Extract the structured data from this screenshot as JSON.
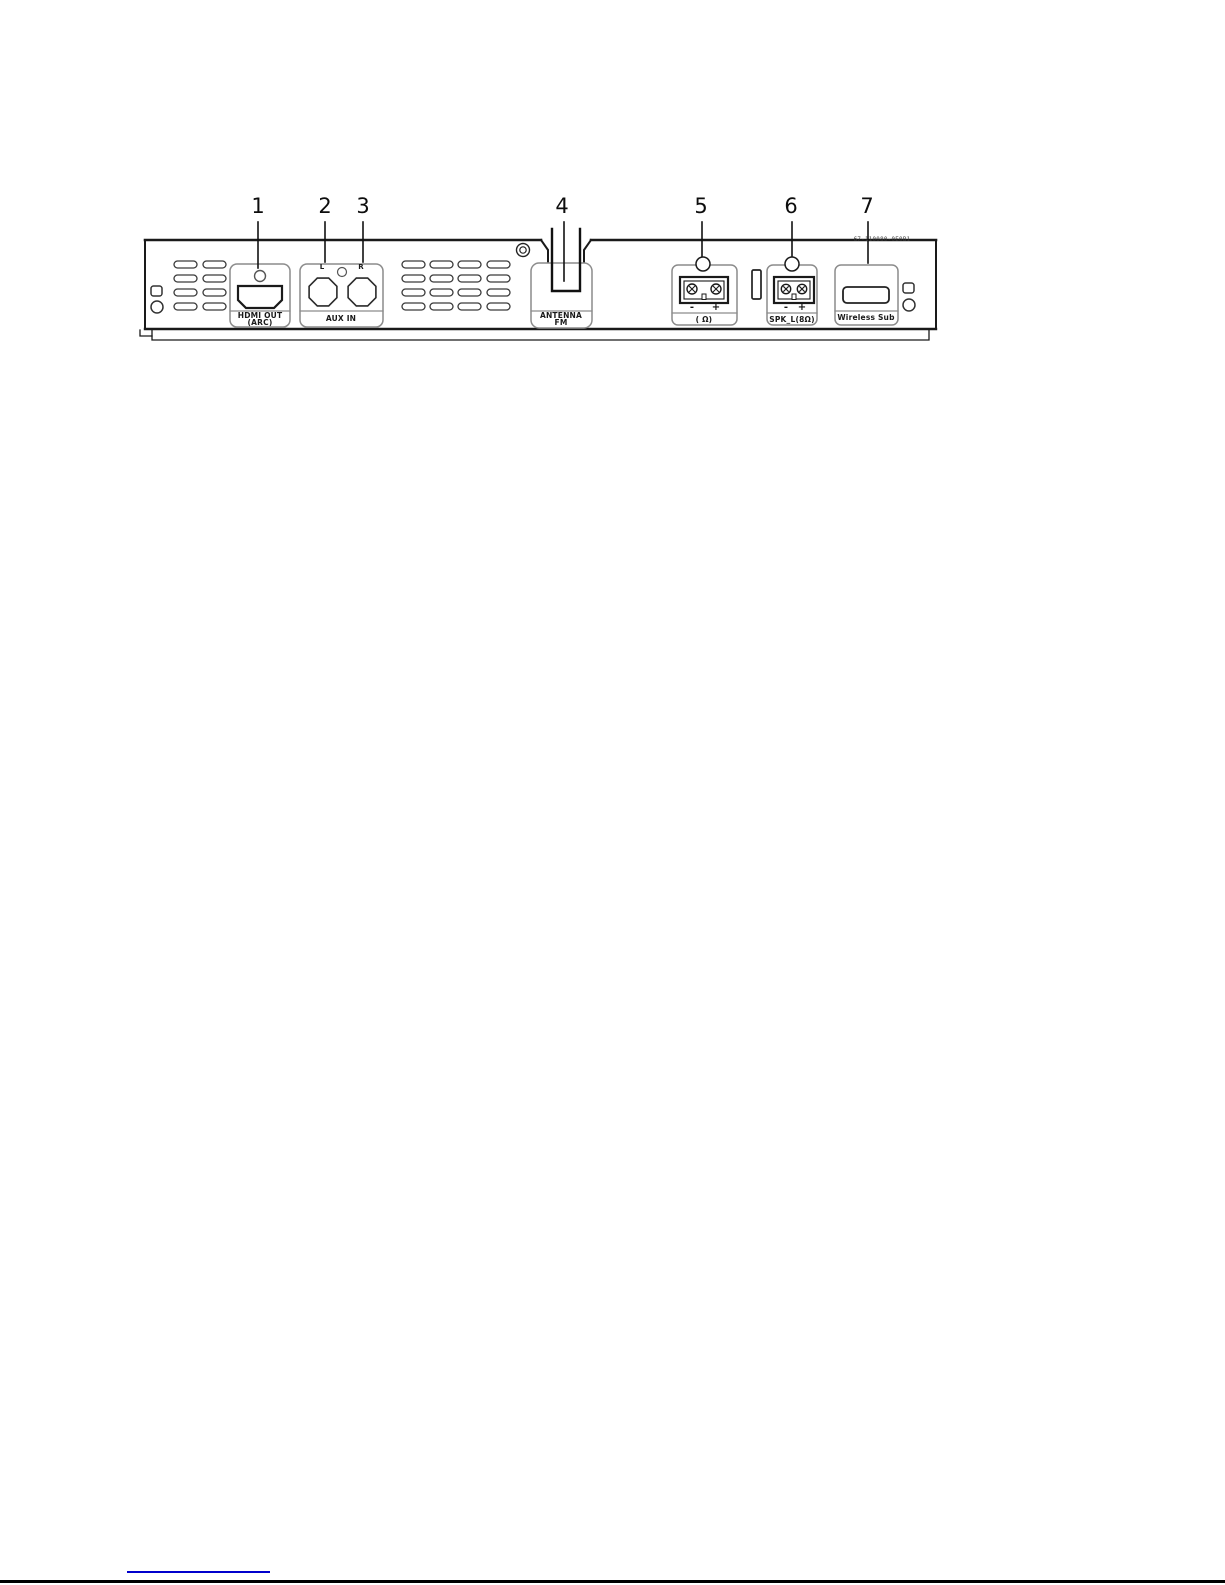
{
  "diagram_title": "rear-panel-connections",
  "callouts": [
    "1",
    "2",
    "3",
    "4",
    "5",
    "6",
    "7"
  ],
  "panel": {
    "part_number": "67-110080-0E0B1",
    "hdmi": {
      "label_line1": "HDMI OUT",
      "label_line2": "(ARC)"
    },
    "aux": {
      "label": "AUX IN",
      "jack_left": "L",
      "jack_right": "R"
    },
    "antenna": {
      "label_line1": "ANTENNA",
      "label_line2": "FM"
    },
    "spk_r": {
      "label": "( Ω)",
      "minus": "-",
      "plus": "+"
    },
    "spk_l": {
      "label": "SPK_L(8Ω)",
      "minus": "-",
      "plus": "+"
    },
    "wireless_sub": {
      "label": "Wireless Sub"
    }
  },
  "icons": {
    "screw": "screw-icon",
    "keyhole_mount_left": "keyhole-mount-icon",
    "keyhole_mount_right": "keyhole-mount-icon",
    "vents": "vent-slots"
  },
  "colors": {
    "line": "#1a1a1a",
    "port_box": "#8c8c8c",
    "link": "#0000cc",
    "page_rule": "#000000"
  }
}
